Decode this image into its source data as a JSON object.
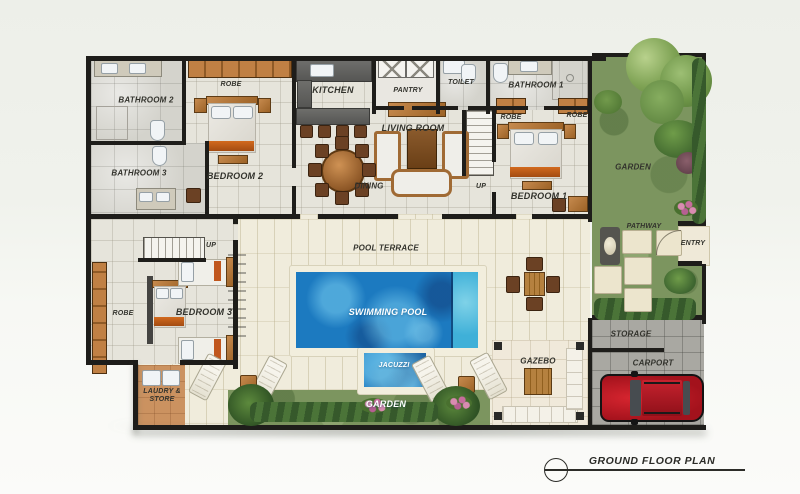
{
  "plan": {
    "title": "GROUND FLOOR PLAN",
    "rooms": {
      "bathroom2": "BATHROOM 2",
      "bathroom3": "BATHROOM 3",
      "robe_bedroom2": "ROBE",
      "bedroom2": "BEDROOM 2",
      "kitchen": "KITCHEN",
      "pantry": "PANTRY",
      "toilet": "TOILET",
      "bathroom1": "BATHROOM 1",
      "robe_bedroom1_left": "ROBE",
      "robe_bedroom1_right": "ROBE",
      "living_room": "LIVING ROOM",
      "dining": "DINING",
      "bedroom1": "BEDROOM 1",
      "garden_side": "GARDEN",
      "pathway": "PATHWAY",
      "entry": "ENTRY",
      "pool_terrace": "POOL TERRACE",
      "swimming_pool": "SWIMMING POOL",
      "jacuzzi": "JACUZZI",
      "robe_bedroom3": "ROBE",
      "bedroom3": "BEDROOM 3",
      "laundry_store": "LAUDRY & STORE",
      "garden_bottom": "GARDEN",
      "gazebo": "GAZEBO",
      "storage": "STORAGE",
      "carport": "CARPORT"
    },
    "stairs": {
      "up_main": "UP",
      "up_wing": "UP"
    },
    "colors": {
      "wall": "#1e1d1a",
      "room_tile": "#e6e4db",
      "bathroom_stone": "#d4d3cc",
      "terrace_plank": "#f0ecdc",
      "paving": "#a9a8a2",
      "grass": "#7c955f",
      "hedge_dark": "#36592b",
      "pool_water": "#1c7ac0",
      "pool_coping": "#f2eedd",
      "wood_furniture": "#b97a45",
      "accent_orange": "#c0561d",
      "car_red": "#b81c26",
      "label_dark": "#33332d",
      "label_light": "#ffffff"
    }
  }
}
